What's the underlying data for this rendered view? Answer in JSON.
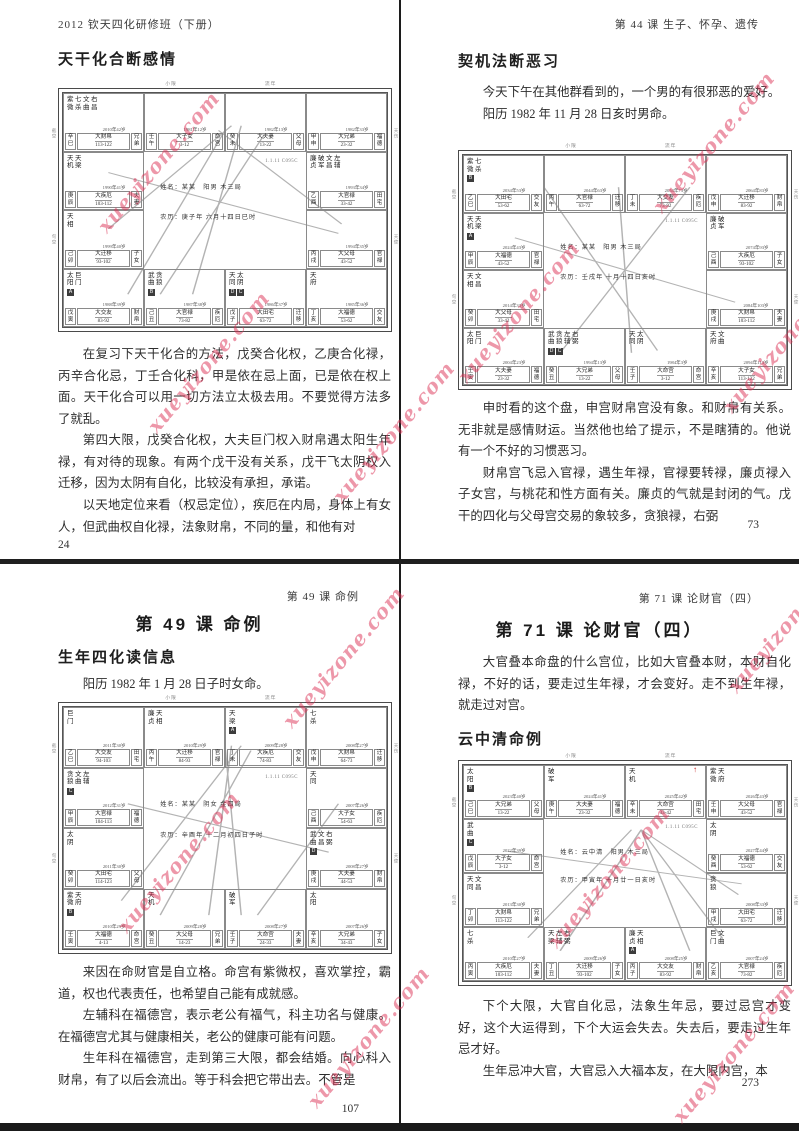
{
  "watermark": {
    "text": "xueyizone.com",
    "color": "#db3054"
  },
  "chart_common": {
    "code": "1.1.11 C095C",
    "side_labels": [
      "截空",
      "旬空",
      "天伤",
      "天使"
    ],
    "top_labels": [
      "小限",
      "流年"
    ]
  },
  "pages": {
    "tl": {
      "header": "2012 钦天四化研修班（下册）",
      "title": "天干化合断感情",
      "paras": [
        "在复习下天干化合的方法，戊癸合化权，乙庚合化禄，丙辛合化忌，丁壬合化科，甲是依在忌上面，已是依在权上面。天干化合可以用一切方法立太极去用。不要觉得方法多了就乱。",
        "第四大限，戊癸合化权，大夫巨门权入财帛遇太阳生年禄，有对待的现象。有两个戊干没有关系，戊干飞太阴权入迁移，因为太阴有自化，比较没有承担，承诺。",
        "以天地定位来看（权忌定位），疾厄在内局，身体上有女人，但武曲权自化禄，法象财帛，不同的量，和他有对"
      ],
      "page_num": "24"
    },
    "tr": {
      "header": "第 44 课 生子、怀孕、遗传",
      "title": "契机法断恶习",
      "intro": [
        "今天下午在其他群看到的，一个男的有很邪恶的爱好。",
        "阳历 1982 年 11 月 28 日亥时男命。"
      ],
      "paras": [
        "申时看的这个盘，申宫财帛宫没有象。和财帛有关系。无非就是感情财运。当然他也给了提示，不是瞎猜的。他说有一个不好的习惯恶习。",
        "财帛宫飞忌入官禄，遇生年禄，官禄要转禄，廉贞禄入子女宫，与桃花和性方面有关。廉贞的气就是封闭的气。戊干的四化与父母宫交易的象较多，贪狼禄，右弼"
      ],
      "page_num": "73"
    },
    "bl": {
      "header": "第 49 课 命例",
      "chapter_title": "第 49 课 命例",
      "section_title": "生年四化读信息",
      "intro": "阳历 1982 年 1 月 28 日子时女命。",
      "paras": [
        "来因在命财官是自立格。命宫有紫微权，喜欢掌控，霸道，权也代表责任，也希望自己能有成就感。",
        "左辅科在福德宫，表示老公有福气，科主功名与健康。在福德宫尤其与健康相关，老公的健康可能有问题。",
        "生年科在福德宫，走到第三大限，都会结婚。向心科入财帛，有了以后会流出。等于科会把它带出去。不管是"
      ],
      "page_num": "107"
    },
    "br": {
      "header": "第 71 课 论财官（四）",
      "chapter_title": "第 71 课 论财官（四）",
      "intro": "大官叠本命盘的什么宫位，比如大官叠本财，本财自化禄，不好的话，要走过生年禄，才会变好。走不到生年禄，就走过对宫。",
      "section_title": "云中清命例",
      "paras": [
        "下个大限，大官自化忌，法象生年忌，要过忌宫才变好，这个大运得到，下个大运会失去。失去后，要走过生年忌才好。",
        "生年忌冲大官，大官忌入大福本友，在大限内宫，本"
      ],
      "page_num": "273"
    }
  },
  "charts": {
    "tl": {
      "center": {
        "name": "姓名：某某　阳男 木三局",
        "date": "农历：庚子年 六月十四日巳时"
      },
      "lines": [
        [
          14,
          58,
          52,
          14
        ],
        [
          20,
          86,
          50,
          16
        ],
        [
          48,
          16,
          86,
          56
        ],
        [
          30,
          86,
          62,
          18
        ],
        [
          14,
          34,
          85,
          60
        ],
        [
          40,
          86,
          55,
          14
        ]
      ],
      "cells": [
        {
          "c": 1,
          "r": 1,
          "stars": "紫七文右\n微杀曲昌",
          "badges": [],
          "year": "2010年42岁",
          "stem": "辛巳",
          "dx": "大财帛",
          "range": "113-122",
          "palace": "兄弟"
        },
        {
          "c": 2,
          "r": 1,
          "stars": "",
          "badges": [],
          "year": "1981年12岁",
          "stem": "壬午",
          "dx": "大子女",
          "range": "3-12",
          "palace": "命宫"
        },
        {
          "c": 3,
          "r": 1,
          "stars": "",
          "badges": [],
          "year": "1982年13岁",
          "stem": "癸未",
          "dx": "大夫妻",
          "range": "13-22",
          "palace": "父母"
        },
        {
          "c": 4,
          "r": 1,
          "stars": "",
          "badges": [],
          "year": "1982年33岁",
          "stem": "甲申",
          "dx": "大兄弟",
          "range": "23-32",
          "palace": "福德"
        },
        {
          "c": 1,
          "r": 2,
          "stars": "天天\n机梁",
          "badges": [],
          "year": "1990年41岁",
          "stem": "庚辰",
          "dx": "大疾厄",
          "range": "103-112",
          "palace": "夫妻"
        },
        {
          "c": 4,
          "r": 2,
          "stars": "廉破文左\n贞军昌辅",
          "badges": [],
          "year": "1993年34岁",
          "stem": "乙酉",
          "dx": "大官禄",
          "range": "33-42",
          "palace": "田宅"
        },
        {
          "c": 1,
          "r": 3,
          "stars": "天\n相",
          "badges": [],
          "year": "1999年40岁",
          "stem": "己卯",
          "dx": "大迁移",
          "range": "93-102",
          "palace": "子女"
        },
        {
          "c": 4,
          "r": 3,
          "stars": "",
          "badges": [],
          "year": "1994年35岁",
          "stem": "丙戌",
          "dx": "大父母",
          "range": "43-52",
          "palace": "官禄"
        },
        {
          "c": 1,
          "r": 4,
          "stars": "太巨\n阳门",
          "badges": [
            "A"
          ],
          "year": "1988年39岁",
          "stem": "戊寅",
          "dx": "大交友",
          "range": "83-92",
          "palace": "财帛"
        },
        {
          "c": 2,
          "r": 4,
          "stars": "武贪\n曲狼",
          "badges": [
            "B"
          ],
          "year": "1987年38岁",
          "stem": "己丑",
          "dx": "大官禄",
          "range": "73-82",
          "palace": "疾厄"
        },
        {
          "c": 3,
          "r": 4,
          "stars": "天太\n同阴",
          "badges": [
            "D",
            "C"
          ],
          "year": "1986年37岁",
          "stem": "戊子",
          "dx": "大田宅",
          "range": "63-72",
          "palace": "迁移"
        },
        {
          "c": 4,
          "r": 4,
          "stars": "天\n府",
          "badges": [],
          "year": "1985年36岁",
          "stem": "丁亥",
          "dx": "大福德",
          "range": "53-62",
          "palace": "交友"
        }
      ]
    },
    "tr": {
      "center": {
        "name": "姓名：某某　阳男 木三局",
        "date": "农历：壬戌年 十月十四日亥时"
      },
      "lines": [
        [
          16,
          36,
          84,
          64
        ],
        [
          25,
          14,
          60,
          85
        ],
        [
          48,
          14,
          52,
          86
        ],
        [
          70,
          14,
          30,
          86
        ]
      ],
      "cells": [
        {
          "c": 1,
          "r": 1,
          "stars": "紫七\n微杀",
          "badges": [
            "B"
          ],
          "year": "2034年53岁",
          "stem": "乙巳",
          "dx": "大田宅",
          "range": "53-62",
          "palace": "交友"
        },
        {
          "c": 2,
          "r": 1,
          "stars": "",
          "badges": [],
          "year": "2044年63岁",
          "stem": "丙午",
          "dx": "大官禄",
          "range": "63-72",
          "palace": "迁移"
        },
        {
          "c": 3,
          "r": 1,
          "stars": "",
          "badges": [],
          "year": "2054年73岁",
          "stem": "丁未",
          "dx": "大交友",
          "range": "73-82",
          "palace": "疾厄"
        },
        {
          "c": 4,
          "r": 1,
          "stars": "",
          "badges": [],
          "year": "2064年83岁",
          "stem": "戊申",
          "dx": "大迁移",
          "range": "83-92",
          "palace": "财帛"
        },
        {
          "c": 1,
          "r": 2,
          "stars": "天天\n机梁",
          "badges": [
            "A"
          ],
          "year": "2024年43岁",
          "stem": "甲辰",
          "dx": "大福德",
          "range": "43-52",
          "palace": "官禄"
        },
        {
          "c": 4,
          "r": 2,
          "stars": "廉破\n贞军",
          "badges": [],
          "year": "2074年93岁",
          "stem": "己酉",
          "dx": "大疾厄",
          "range": "93-102",
          "palace": "子女"
        },
        {
          "c": 1,
          "r": 3,
          "stars": "天文\n相昌",
          "badges": [],
          "year": "2014年33岁",
          "stem": "癸卯",
          "dx": "大父母",
          "range": "33-42",
          "palace": "田宅"
        },
        {
          "c": 4,
          "r": 3,
          "stars": "",
          "badges": [],
          "year": "2084年103岁",
          "stem": "庚戌",
          "dx": "大财帛",
          "range": "103-112",
          "palace": "夫妻"
        },
        {
          "c": 1,
          "r": 4,
          "stars": "太巨\n阳门",
          "badges": [],
          "year": "2004年23岁",
          "stem": "壬寅",
          "dx": "大夫妻",
          "range": "23-32",
          "palace": "福德"
        },
        {
          "c": 2,
          "r": 4,
          "stars": "武贪左右\n曲狼辅弼",
          "badges": [
            "D",
            "C"
          ],
          "year": "1994年13岁",
          "stem": "癸丑",
          "dx": "大兄弟",
          "range": "13-22",
          "palace": "父母"
        },
        {
          "c": 3,
          "r": 4,
          "stars": "天太\n同阴",
          "badges": [],
          "year": "1984年3岁",
          "stem": "壬子",
          "dx": "大命宫",
          "range": "3-12",
          "palace": "命宫"
        },
        {
          "c": 4,
          "r": 4,
          "stars": "天文\n府曲",
          "badges": [],
          "year": "2094年113岁",
          "stem": "辛亥",
          "dx": "大子女",
          "range": "113-122",
          "palace": "兄弟"
        }
      ]
    },
    "bl": {
      "center": {
        "name": "姓名：某某　阴女 金四局",
        "date": "农历：辛酉年 十二月初四日子时"
      },
      "lines": [
        [
          18,
          80,
          55,
          16
        ],
        [
          30,
          86,
          58,
          18
        ],
        [
          45,
          86,
          52,
          16
        ],
        [
          20,
          40,
          82,
          60
        ],
        [
          60,
          86,
          85,
          40
        ],
        [
          50,
          16,
          55,
          86
        ]
      ],
      "cells": [
        {
          "c": 1,
          "r": 1,
          "stars": "巨\n门",
          "badges": [],
          "year": "2011年30岁",
          "stem": "乙巳",
          "dx": "大交友",
          "range": "94-103",
          "palace": "田宅"
        },
        {
          "c": 2,
          "r": 1,
          "stars": "廉天\n贞相",
          "badges": [],
          "year": "2010年29岁",
          "stem": "丙午",
          "dx": "大迁移",
          "range": "84-93",
          "palace": "官禄"
        },
        {
          "c": 3,
          "r": 1,
          "stars": "天\n梁",
          "badges": [
            "A"
          ],
          "year": "2009年28岁",
          "stem": "丁未",
          "dx": "大疾厄",
          "range": "74-83",
          "palace": "交友"
        },
        {
          "c": 4,
          "r": 1,
          "stars": "七\n杀",
          "badges": [],
          "year": "2008年27岁",
          "stem": "戊申",
          "dx": "大财帛",
          "range": "64-73",
          "palace": "迁移"
        },
        {
          "c": 1,
          "r": 2,
          "stars": "贪文左\n狼曲辅",
          "badges": [
            "C"
          ],
          "year": "2012年31岁",
          "stem": "甲辰",
          "dx": "大官禄",
          "range": "104-113",
          "palace": "福德"
        },
        {
          "c": 4,
          "r": 2,
          "stars": "天\n同",
          "badges": [],
          "year": "2007年26岁",
          "stem": "己酉",
          "dx": "大子女",
          "range": "54-63",
          "palace": "疾厄"
        },
        {
          "c": 1,
          "r": 3,
          "stars": "太\n阴",
          "badges": [],
          "year": "2011年30岁",
          "stem": "癸卯",
          "dx": "大田宅",
          "range": "114-123",
          "palace": "父母"
        },
        {
          "c": 4,
          "r": 3,
          "stars": "武文右\n曲昌弼",
          "badges": [
            "D"
          ],
          "year": "2008年27岁",
          "stem": "庚戌",
          "dx": "大夫妻",
          "range": "44-53",
          "palace": "财帛"
        },
        {
          "c": 1,
          "r": 4,
          "stars": "紫天\n微府",
          "badges": [
            "B"
          ],
          "year": "2010年29岁",
          "stem": "壬寅",
          "dx": "大福德",
          "range": "4-13",
          "palace": "命宫"
        },
        {
          "c": 2,
          "r": 4,
          "stars": "天\n机",
          "badges": [],
          "year": "2009年28岁",
          "stem": "癸丑",
          "dx": "大父母",
          "range": "14-23",
          "palace": "兄弟"
        },
        {
          "c": 3,
          "r": 4,
          "stars": "破\n军",
          "badges": [],
          "year": "2008年27岁",
          "stem": "壬子",
          "dx": "大命宫",
          "range": "24-33",
          "palace": "夫妻"
        },
        {
          "c": 4,
          "r": 4,
          "stars": "太\n阳",
          "badges": [],
          "year": "2007年26岁",
          "stem": "辛亥",
          "dx": "大兄弟",
          "range": "34-43",
          "palace": "子女"
        }
      ]
    },
    "br": {
      "red_mark": "↑",
      "center": {
        "name": "姓名：云中清　阳男 木三局",
        "date": "农历：甲寅年 十月廿一日亥时"
      },
      "lines": [
        [
          14,
          40,
          86,
          55
        ],
        [
          20,
          80,
          52,
          30
        ],
        [
          30,
          86,
          55,
          30
        ],
        [
          55,
          30,
          85,
          60
        ],
        [
          55,
          30,
          80,
          80
        ],
        [
          55,
          30,
          30,
          86
        ],
        [
          55,
          30,
          70,
          86
        ]
      ],
      "cells": [
        {
          "c": 1,
          "r": 1,
          "stars": "太\n阳",
          "badges": [
            "B"
          ],
          "year": "2023年40岁",
          "stem": "己巳",
          "dx": "大兄弟",
          "range": "13-22",
          "palace": "父母"
        },
        {
          "c": 2,
          "r": 1,
          "stars": "破\n军",
          "badges": [],
          "year": "2024年41岁",
          "stem": "庚午",
          "dx": "大夫妻",
          "range": "23-32",
          "palace": "福德"
        },
        {
          "c": 3,
          "r": 1,
          "stars": "天\n机",
          "badges": [],
          "year": "2025年42岁",
          "stem": "辛未",
          "dx": "大命宫",
          "range": "33-42",
          "palace": "田宅"
        },
        {
          "c": 4,
          "r": 1,
          "stars": "紫天\n微府",
          "badges": [],
          "year": "2026年43岁",
          "stem": "壬申",
          "dx": "大父母",
          "range": "43-52",
          "palace": "官禄"
        },
        {
          "c": 1,
          "r": 2,
          "stars": "武\n曲",
          "badges": [
            "C"
          ],
          "year": "2022年39岁",
          "stem": "戊辰",
          "dx": "大子女",
          "range": "3-12",
          "palace": "命宫"
        },
        {
          "c": 4,
          "r": 2,
          "stars": "太\n阴",
          "badges": [],
          "year": "2027年44岁",
          "stem": "癸酉",
          "dx": "大福德",
          "range": "53-62",
          "palace": "交友"
        },
        {
          "c": 1,
          "r": 3,
          "stars": "天文\n同昌",
          "badges": [],
          "year": "2013年30岁",
          "stem": "丁卯",
          "dx": "大财帛",
          "range": "113-122",
          "palace": "兄弟"
        },
        {
          "c": 4,
          "r": 3,
          "stars": "贪\n狼",
          "badges": [],
          "year": "2008年33岁",
          "stem": "甲戌",
          "dx": "大田宅",
          "range": "63-72",
          "palace": "迁移"
        },
        {
          "c": 1,
          "r": 4,
          "stars": "七\n杀",
          "badges": [],
          "year": "2010年27岁",
          "stem": "丙寅",
          "dx": "大疾厄",
          "range": "103-112",
          "palace": "夫妻"
        },
        {
          "c": 2,
          "r": 4,
          "stars": "天左右\n梁辅弼",
          "badges": [],
          "year": "2009年26岁",
          "stem": "丁丑",
          "dx": "大迁移",
          "range": "93-102",
          "palace": "子女"
        },
        {
          "c": 3,
          "r": 4,
          "stars": "廉天\n贞相",
          "badges": [
            "A"
          ],
          "year": "2008年25岁",
          "stem": "丙子",
          "dx": "大交友",
          "range": "83-92",
          "palace": "财帛"
        },
        {
          "c": 4,
          "r": 4,
          "stars": "巨文\n门曲",
          "badges": [],
          "year": "2007年24岁",
          "stem": "乙亥",
          "dx": "大官禄",
          "range": "73-82",
          "palace": "疾厄"
        }
      ]
    }
  }
}
